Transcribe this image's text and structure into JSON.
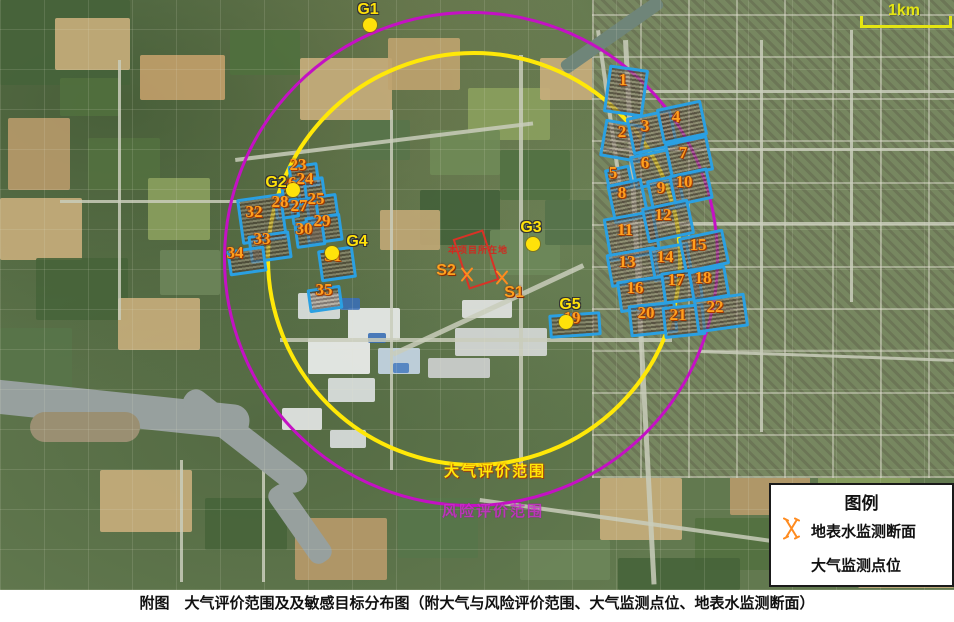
{
  "caption": "附图　大气评价范围及及敏感目标分布图（附大气与风险评价范围、大气监测点位、地表水监测断面）",
  "scale_bar": {
    "label": "1km"
  },
  "circles": {
    "air": {
      "label": "大气评价范围",
      "color": "#ffe808",
      "cx": 470,
      "cy": 255,
      "r": 204
    },
    "risk": {
      "label": "风险评价范围",
      "color": "#c411c4",
      "cx": 468,
      "cy": 256,
      "r": 245
    }
  },
  "site": {
    "label": "本项目所在地",
    "color": "#d93226"
  },
  "air_monitoring_points": [
    {
      "id": "G1",
      "label_x": 368,
      "label_y": 10,
      "dot_x": 370,
      "dot_y": 25
    },
    {
      "id": "G2",
      "label_x": 276,
      "label_y": 183,
      "dot_x": 293,
      "dot_y": 190
    },
    {
      "id": "G3",
      "label_x": 531,
      "label_y": 228,
      "dot_x": 533,
      "dot_y": 244
    },
    {
      "id": "G4",
      "label_x": 357,
      "label_y": 242,
      "dot_x": 332,
      "dot_y": 253
    },
    {
      "id": "G5",
      "label_x": 570,
      "label_y": 305,
      "dot_x": 566,
      "dot_y": 322
    }
  ],
  "water_sections": [
    {
      "id": "S1",
      "label_x": 514,
      "label_y": 293,
      "sym_x": 502,
      "sym_y": 280
    },
    {
      "id": "S2",
      "label_x": 446,
      "label_y": 271,
      "sym_x": 467,
      "sym_y": 277
    }
  ],
  "sensitive_targets": [
    {
      "n": 1,
      "x": 623,
      "y": 80,
      "poly": {
        "cx": 623,
        "cy": 88,
        "w": 34,
        "h": 42,
        "rot": 8
      }
    },
    {
      "n": 2,
      "x": 622,
      "y": 132,
      "poly": {
        "cx": 620,
        "cy": 138,
        "w": 36,
        "h": 32,
        "rot": 10
      }
    },
    {
      "n": 3,
      "x": 645,
      "y": 126,
      "poly": {
        "cx": 649,
        "cy": 129,
        "w": 40,
        "h": 32,
        "rot": -12
      }
    },
    {
      "n": 4,
      "x": 676,
      "y": 117,
      "poly": {
        "cx": 679,
        "cy": 119,
        "w": 40,
        "h": 30,
        "rot": -12
      }
    },
    {
      "n": 5,
      "x": 613,
      "y": 173,
      "poly": {
        "cx": 616,
        "cy": 176,
        "w": 20,
        "h": 18,
        "rot": -12
      }
    },
    {
      "n": 6,
      "x": 645,
      "y": 163,
      "poly": {
        "cx": 649,
        "cy": 166,
        "w": 34,
        "h": 28,
        "rot": -12
      }
    },
    {
      "n": 7,
      "x": 683,
      "y": 153,
      "poly": {
        "cx": 686,
        "cy": 154,
        "w": 38,
        "h": 30,
        "rot": -12
      }
    },
    {
      "n": 8,
      "x": 622,
      "y": 193,
      "poly": {
        "cx": 625,
        "cy": 198,
        "w": 30,
        "h": 34,
        "rot": -12
      }
    },
    {
      "n": 9,
      "x": 661,
      "y": 188,
      "poly": {
        "cx": 663,
        "cy": 191,
        "w": 28,
        "h": 28,
        "rot": -12
      }
    },
    {
      "n": 10,
      "x": 684,
      "y": 182,
      "poly": {
        "cx": 688,
        "cy": 184,
        "w": 34,
        "h": 26,
        "rot": -12
      }
    },
    {
      "n": 11,
      "x": 625,
      "y": 230,
      "poly": {
        "cx": 629,
        "cy": 233,
        "w": 46,
        "h": 38,
        "rot": -10
      }
    },
    {
      "n": 12,
      "x": 663,
      "y": 215,
      "poly": {
        "cx": 665,
        "cy": 218,
        "w": 42,
        "h": 30,
        "rot": -12
      }
    },
    {
      "n": 13,
      "x": 627,
      "y": 262,
      "poly": {
        "cx": 630,
        "cy": 264,
        "w": 44,
        "h": 28,
        "rot": -10
      }
    },
    {
      "n": 14,
      "x": 665,
      "y": 257,
      "poly": {
        "cx": 668,
        "cy": 259,
        "w": 34,
        "h": 28,
        "rot": -10
      }
    },
    {
      "n": 15,
      "x": 698,
      "y": 245,
      "poly": {
        "cx": 701,
        "cy": 248,
        "w": 40,
        "h": 30,
        "rot": -12
      }
    },
    {
      "n": 16,
      "x": 635,
      "y": 288,
      "poly": {
        "cx": 639,
        "cy": 291,
        "w": 42,
        "h": 26,
        "rot": -8
      }
    },
    {
      "n": 17,
      "x": 676,
      "y": 280,
      "poly": {
        "cx": 679,
        "cy": 283,
        "w": 34,
        "h": 26,
        "rot": -8
      }
    },
    {
      "n": 18,
      "x": 703,
      "y": 278,
      "poly": {
        "cx": 706,
        "cy": 281,
        "w": 32,
        "h": 26,
        "rot": -10
      }
    },
    {
      "n": 19,
      "x": 572,
      "y": 318,
      "poly": {
        "cx": 572,
        "cy": 322,
        "w": 46,
        "h": 18,
        "rot": -4
      }
    },
    {
      "n": 20,
      "x": 646,
      "y": 313,
      "poly": {
        "cx": 650,
        "cy": 316,
        "w": 42,
        "h": 26,
        "rot": -6
      }
    },
    {
      "n": 21,
      "x": 678,
      "y": 315,
      "poly": {
        "cx": 681,
        "cy": 318,
        "w": 36,
        "h": 26,
        "rot": -6
      }
    },
    {
      "n": 22,
      "x": 715,
      "y": 307,
      "poly": {
        "cx": 718,
        "cy": 310,
        "w": 46,
        "h": 28,
        "rot": -8
      }
    },
    {
      "n": 23,
      "x": 298,
      "y": 165,
      "poly": {
        "cx": 301,
        "cy": 173,
        "w": 24,
        "h": 18,
        "rot": -8
      }
    },
    {
      "n": 24,
      "x": 305,
      "y": 179,
      "poly": {
        "cx": 308,
        "cy": 186,
        "w": 22,
        "h": 16,
        "rot": -8
      }
    },
    {
      "n": 25,
      "x": 316,
      "y": 199,
      "poly": {
        "cx": 319,
        "cy": 204,
        "w": 26,
        "h": 18,
        "rot": -8
      }
    },
    {
      "n": 26,
      "x": 288,
      "y": 183,
      "poly": {
        "cx": 291,
        "cy": 188,
        "w": 20,
        "h": 16,
        "rot": -8
      }
    },
    {
      "n": 27,
      "x": 299,
      "y": 206,
      "poly": {
        "cx": 302,
        "cy": 210,
        "w": 22,
        "h": 16,
        "rot": -8
      }
    },
    {
      "n": 28,
      "x": 280,
      "y": 202,
      "poly": {
        "cx": 284,
        "cy": 206,
        "w": 18,
        "h": 14,
        "rot": -8
      }
    },
    {
      "n": 29,
      "x": 322,
      "y": 221,
      "poly": {
        "cx": 321,
        "cy": 226,
        "w": 30,
        "h": 22,
        "rot": -8
      }
    },
    {
      "n": 30,
      "x": 304,
      "y": 229,
      "poly": {
        "cx": 307,
        "cy": 232,
        "w": 24,
        "h": 18,
        "rot": -8
      }
    },
    {
      "n": 31,
      "x": 333,
      "y": 256,
      "poly": {
        "cx": 334,
        "cy": 261,
        "w": 30,
        "h": 26,
        "rot": -8
      }
    },
    {
      "n": 32,
      "x": 254,
      "y": 212,
      "poly": {
        "cx": 259,
        "cy": 216,
        "w": 40,
        "h": 40,
        "rot": -8
      }
    },
    {
      "n": 33,
      "x": 262,
      "y": 239,
      "poly": {
        "cx": 267,
        "cy": 244,
        "w": 36,
        "h": 22,
        "rot": -8
      }
    },
    {
      "n": 34,
      "x": 235,
      "y": 253,
      "poly": {
        "cx": 244,
        "cy": 258,
        "w": 32,
        "h": 20,
        "rot": -8
      }
    },
    {
      "n": 35,
      "x": 324,
      "y": 290,
      "poly": {
        "cx": 322,
        "cy": 296,
        "w": 28,
        "h": 18,
        "rot": -8
      }
    }
  ],
  "legend": {
    "title": "图例",
    "items": [
      {
        "icon": "water-section-icon",
        "label": "地表水监测断面"
      },
      {
        "icon": "air-point-icon",
        "label": "大气监测点位"
      }
    ]
  }
}
